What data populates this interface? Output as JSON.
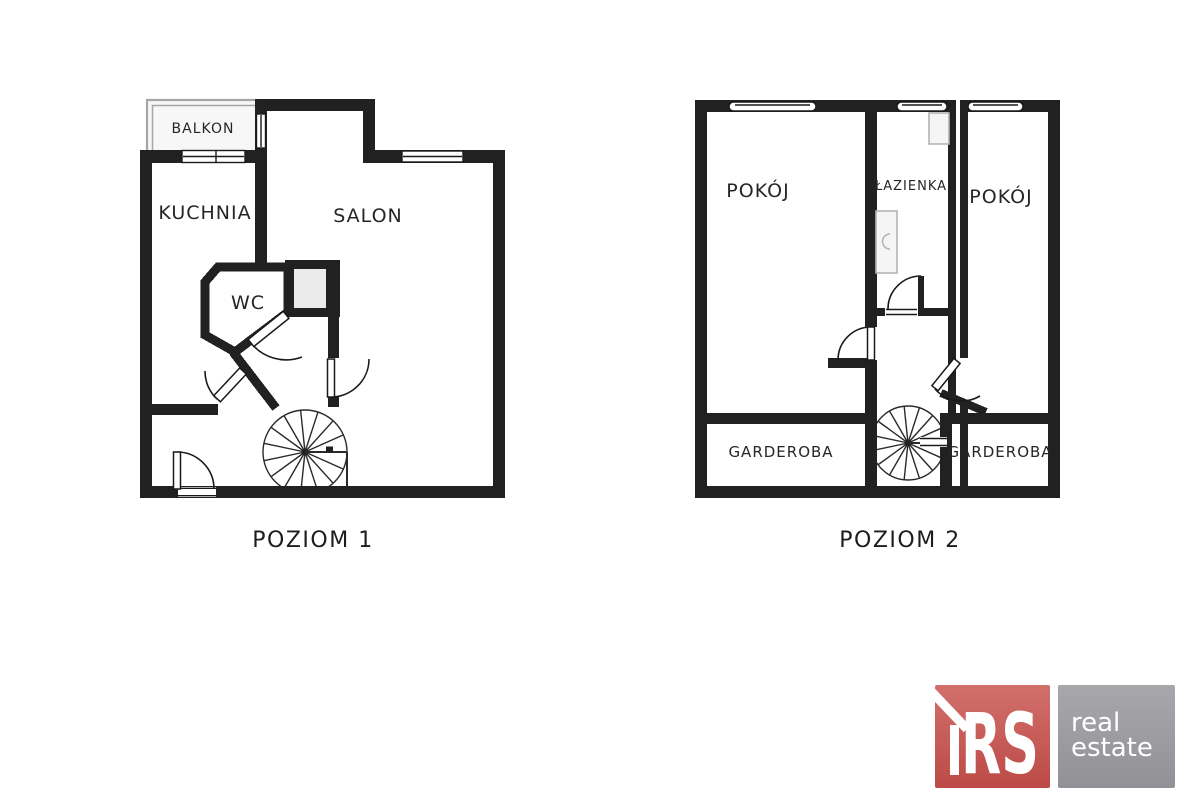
{
  "level1": {
    "caption": "POZIOM 1",
    "labels": {
      "balcony": "BALKON",
      "kitchen": "KUCHNIA",
      "living_room": "SALON",
      "wc": "WC"
    }
  },
  "level2": {
    "caption": "POZIOM 2",
    "labels": {
      "room_left": "POKÓJ",
      "bathroom": "ŁAZIENKA",
      "room_right": "POKÓJ",
      "wardrobe_left": "GARDEROBA",
      "wardrobe_right": "GARDEROBA"
    }
  },
  "logo": {
    "brand": "RS",
    "tagline_top": "real",
    "tagline_bottom": "estate"
  },
  "colors": {
    "wall": "#212121",
    "line": "#1a1a1a",
    "text": "#262626",
    "fixture_stroke": "#b4b4b4",
    "fixture_fill": "#f5f5f5",
    "balcony_outline": "#a6a6a6",
    "balcony_fill": "#f7f7f7",
    "shaft_fill": "#ebebeb",
    "brand_bg_light": "#d2706c",
    "brand_bg_dark": "#bc4a46",
    "tagline_bg_light": "#a8a7ab",
    "tagline_bg_dark": "#929196",
    "logo_text": "#ffffff"
  }
}
